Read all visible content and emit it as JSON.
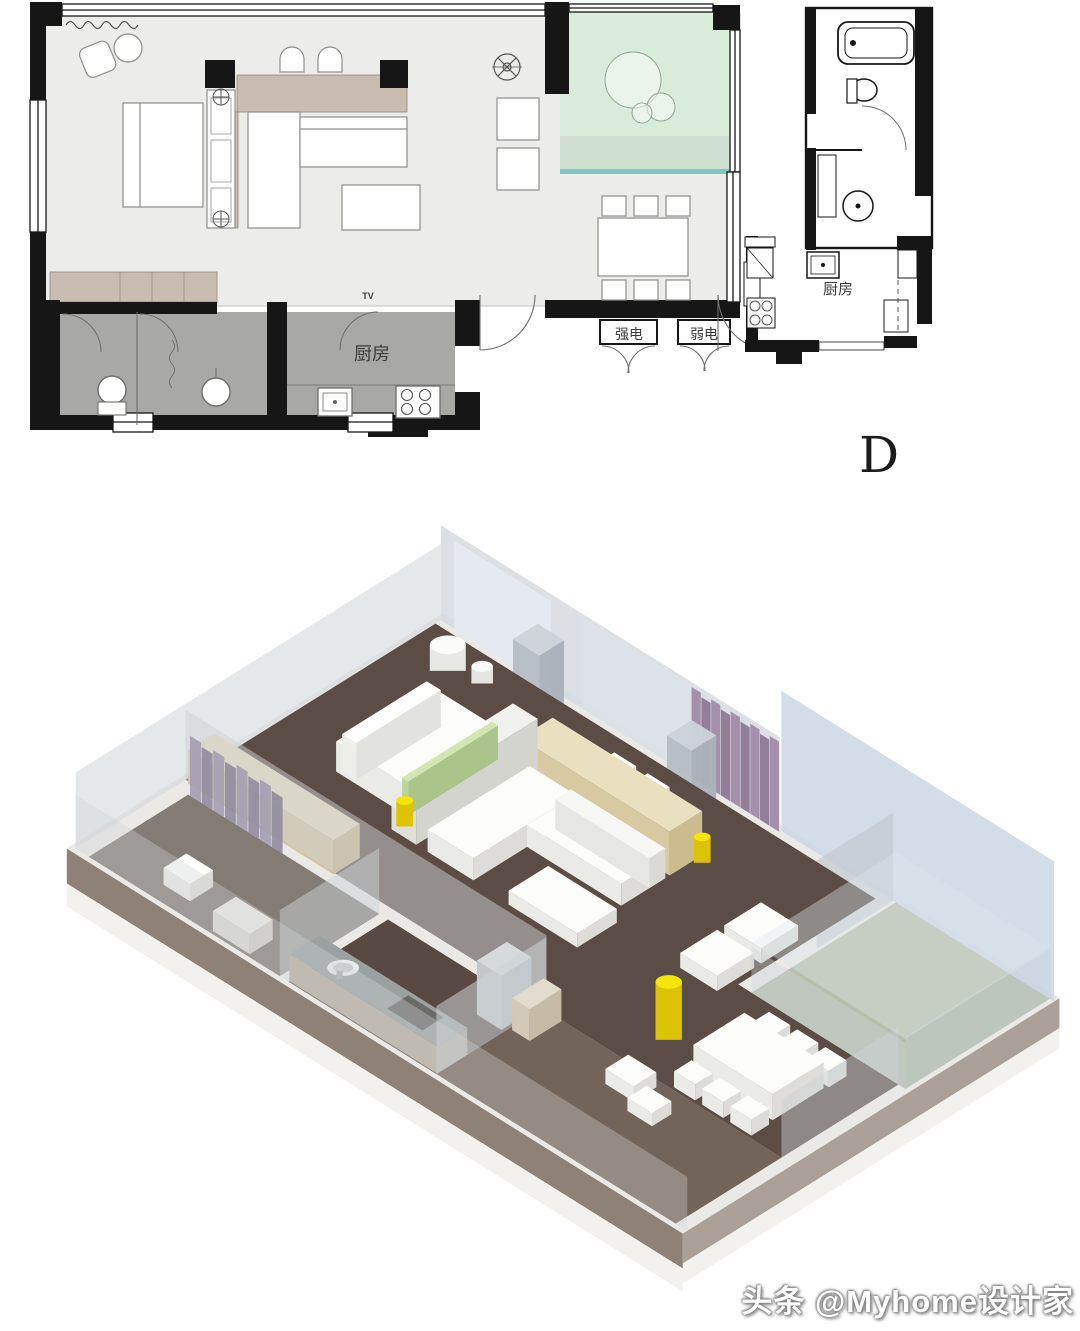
{
  "page": {
    "background": "#ffffff"
  },
  "floor_plan": {
    "unit_letter": "D",
    "labels": {
      "kitchen_main": "厨房",
      "kitchen_right_unit": "厨房",
      "strong_electric": "强电",
      "weak_electric": "弱电",
      "tv": "TV"
    },
    "colors": {
      "wall_black": "#161616",
      "room_fill": "#ecedeb",
      "wet_room_fill": "#a8a8a6",
      "balcony_fill": "#d9ebd9",
      "balcony_band": "#cfe0d2",
      "cabinet_tan": "#c9bdb1",
      "accent_teal": "#7cc7c0"
    }
  },
  "render_3d": {
    "colors": {
      "floor_dark": "#5b4d45",
      "floor_entry": "#73645a",
      "floor_kitchen": "#584a43",
      "floor_bath": "#7d766f",
      "wall_glass": "#c9d6e3",
      "wall_gray": "#d6dbdf",
      "beige_top": "#eadfbe",
      "accent_yellow": "#f7e509",
      "yellow_side": "#dcc303",
      "curtain_purple": "#9d87a4",
      "curtain_purple_dark": "#8a7390",
      "balcony_green": "#aeb6a0",
      "slab_edge_dark": "#8d8178",
      "slab_edge_light": "#aaa098",
      "slab_rim": "#f2f1ee",
      "furniture_white": "#fdfdfc"
    }
  },
  "watermark": {
    "text": "头条 @Myhome设计家"
  }
}
